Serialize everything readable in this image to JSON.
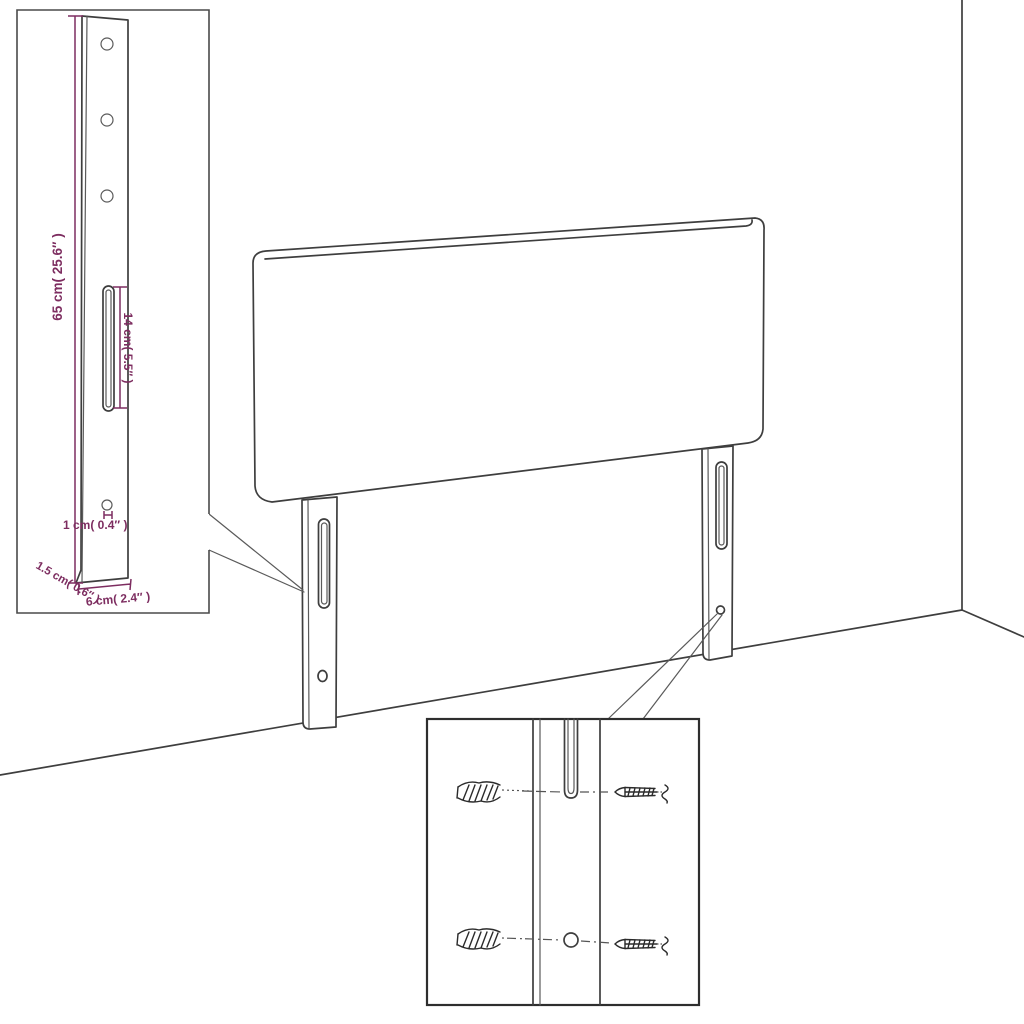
{
  "figure": {
    "subject": "headboard-with-mounting-legs-assembly-diagram",
    "colors": {
      "line": "#3e3e3e",
      "dimension": "#7d2d60",
      "background": "#ffffff"
    },
    "leg_inset": {
      "dimensions": {
        "height": "65 cm( 25.6″ )",
        "slot_length": "14 cm( 5.5″ )",
        "hole_diameter": "1 cm( 0.4″ )",
        "thickness": "1.5 cm( 0.6″ )",
        "width": "6 cm( 2.4″ )"
      }
    }
  }
}
